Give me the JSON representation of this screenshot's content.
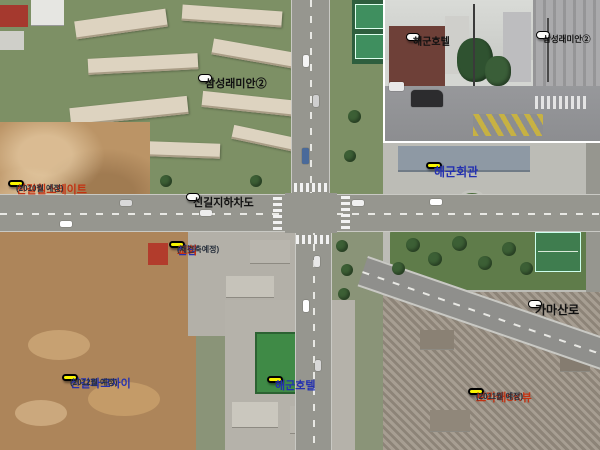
{
  "map_labels": {
    "samsung_raemian": {
      "text": "삼성래미안②"
    },
    "singil_hillstate": {
      "title": "신길힐스테이트",
      "sub": "(2010월 예정)"
    },
    "singil_underpass": {
      "text": "신길지하차도"
    },
    "sinnam_church": {
      "name": "신남",
      "suffix": "교회",
      "sub": "(재건축예정)"
    },
    "navy_hall": {
      "text": "해군회관"
    },
    "gamasan_ro": {
      "text": "가마산로"
    },
    "singil_parkxi": {
      "title": "신길파크자이",
      "sub": "(2012월 예정)"
    },
    "navy_hotel": {
      "text": "해군호텔"
    },
    "boramae_skview": {
      "title": "보라매SK뷰",
      "sub": "(2011월 예정)"
    }
  },
  "inset_labels": {
    "navy_hotel": {
      "text": "해군호텔"
    },
    "samsung_raemian": {
      "text": "삼성래미안②"
    }
  },
  "colors": {
    "label_yellow": "#f8f500",
    "label_white": "#fbfbf9",
    "text_red": "#c23212",
    "text_blue": "#2431b0",
    "text_dark": "#28303c"
  }
}
